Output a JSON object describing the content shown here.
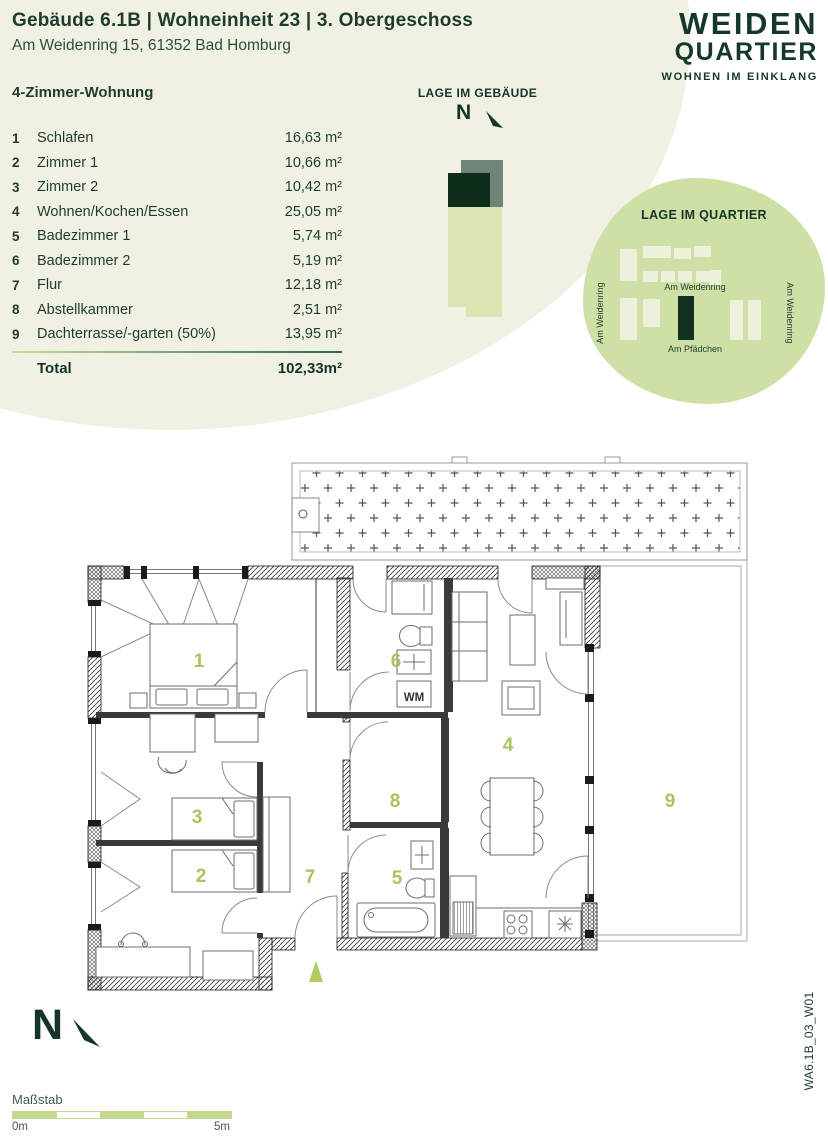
{
  "header": {
    "title": "Gebäude 6.1B | Wohneinheit 23 | 3. Obergeschoss",
    "address": "Am Weidenring 15, 61352 Bad Homburg"
  },
  "logo": {
    "line1": "WEIDEN",
    "line2": "QUARTIER",
    "tagline": "WOHNEN IM EINKLANG"
  },
  "apartment": {
    "type_label": "4-Zimmer-Wohnung",
    "rooms": [
      {
        "num": "1",
        "name": "Schlafen",
        "area": "16,63 m²"
      },
      {
        "num": "2",
        "name": "Zimmer 1",
        "area": "10,66 m²"
      },
      {
        "num": "3",
        "name": "Zimmer 2",
        "area": "10,42 m²"
      },
      {
        "num": "4",
        "name": "Wohnen/Kochen/Essen",
        "area": "25,05 m²"
      },
      {
        "num": "5",
        "name": "Badezimmer 1",
        "area": "5,74 m²"
      },
      {
        "num": "6",
        "name": "Badezimmer 2",
        "area": "5,19 m²"
      },
      {
        "num": "7",
        "name": "Flur",
        "area": "12,18 m²"
      },
      {
        "num": "8",
        "name": "Abstellkammer",
        "area": "2,51 m²"
      },
      {
        "num": "9",
        "name": "Dachterrasse/-garten (50%)",
        "area": "13,95 m²"
      }
    ],
    "total_label": "Total",
    "total_area": "102,33m²"
  },
  "building_location": {
    "title": "LAGE IM GEBÄUDE",
    "north_letter": "N"
  },
  "quarter_location": {
    "title": "LAGE IM QUARTIER",
    "street_left": "Am Weidenring",
    "street_right": "Am Weidenring",
    "street_center": "Am Weidenring",
    "street_bottom": "Am Pfädchen"
  },
  "floorplan": {
    "numbers": [
      "1",
      "2",
      "3",
      "4",
      "5",
      "6",
      "7",
      "8",
      "9"
    ],
    "wm_label": "WM"
  },
  "compass": {
    "north_letter": "N"
  },
  "scale_bar": {
    "label": "Maßstab",
    "start_label": "0m",
    "end_label": "5m"
  },
  "plan_code": "WA6.1B_03_W01",
  "colors": {
    "dark_green": "#16382a",
    "accent_green": "#a9c45f",
    "light_green": "#cfe0a6",
    "cream": "#f0f1e3"
  }
}
